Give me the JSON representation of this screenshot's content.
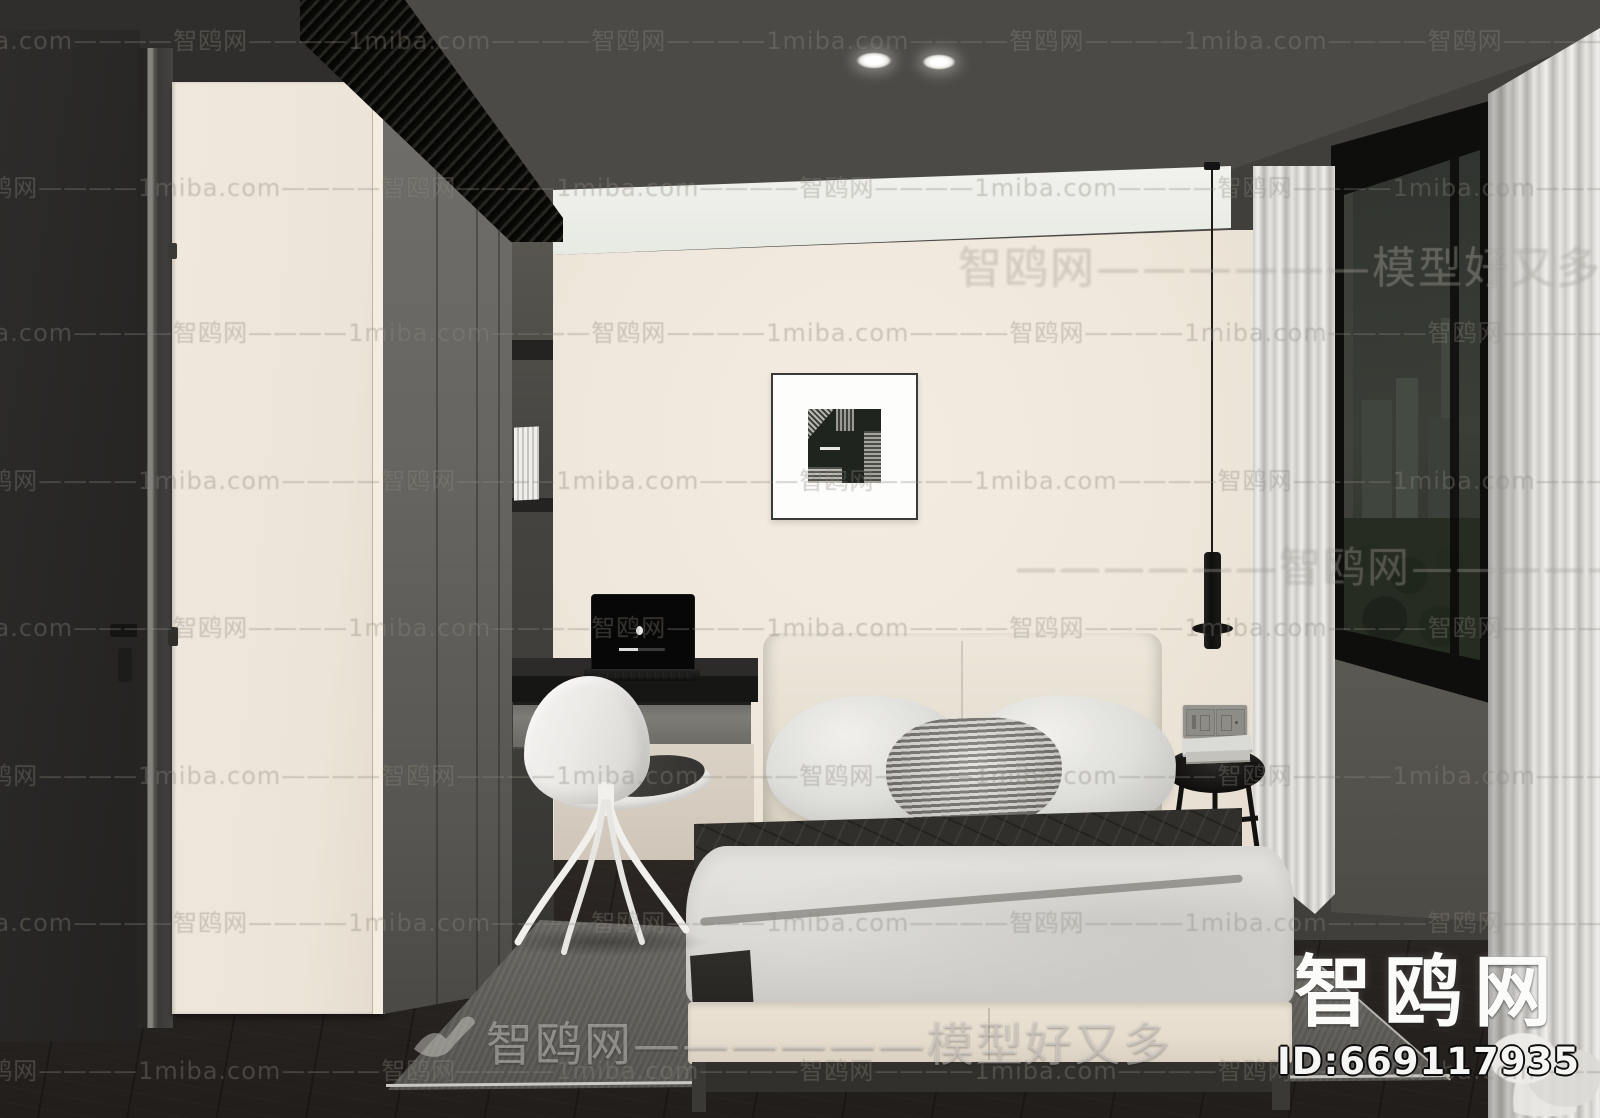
{
  "watermarks": {
    "site_latin": "1miba.com",
    "site_cn": "智鸥网",
    "tile_dashes": "————",
    "slogan": "模型好又多",
    "big_row_top": "智鸥网——————模型好又多————",
    "big_row_mid": "——————智鸥网——————",
    "bottom_center": "智鸥网——————模型好又多",
    "bird_icon": "seagull-icon"
  },
  "branding": {
    "logo_text": "智鸥网",
    "id_text": "ID:669117935"
  },
  "laptop": {
    "logo_icon": "apple-logo-icon"
  },
  "colors": {
    "ceiling": "#4c4a47",
    "back_wall": "#f0e8dd",
    "bulkhead": "#eef0ea",
    "floor": "#2a2522",
    "rug": "#63615c",
    "blanket": "#302f2b",
    "bed_base": "#e8dfd1",
    "curtain": "#e4e3df",
    "wardrobe": "#6b6965",
    "window_night": "#30342e"
  }
}
